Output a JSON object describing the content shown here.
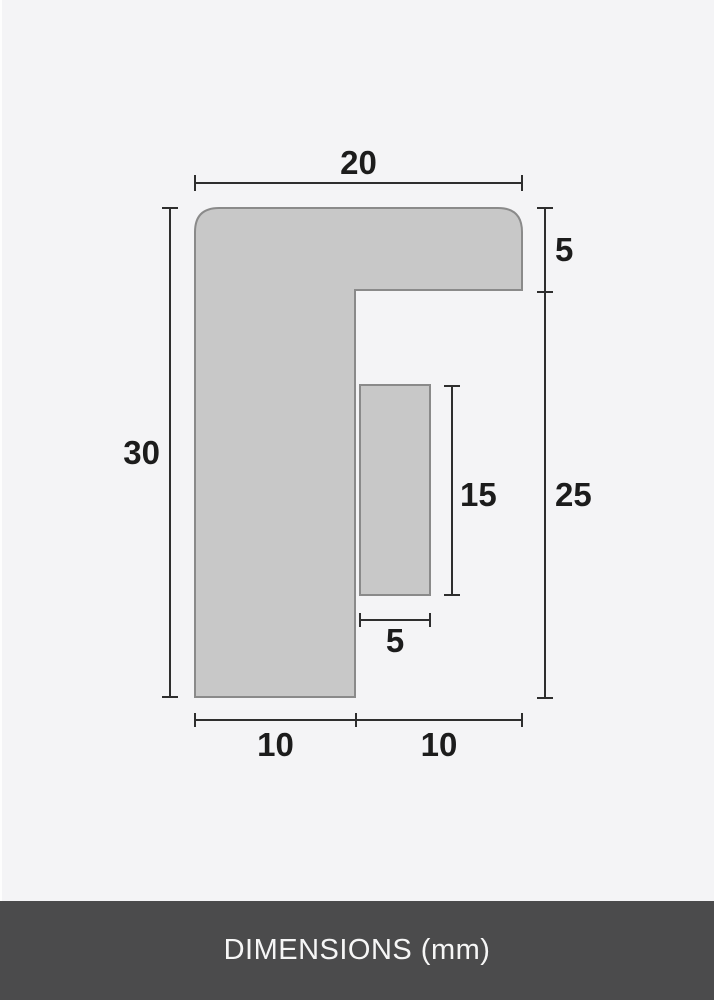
{
  "page": {
    "background_color": "#f4f4f6"
  },
  "figure": {
    "description": "frame-moulding-profile-cross-section",
    "shape_fill": "#c8c8c8",
    "shape_stroke": "#8a8a8a",
    "dimension_line_color": "#2e2e2e"
  },
  "dimensions": {
    "top_width": "20",
    "right_upper_height": "5",
    "left_height": "30",
    "inner_height": "15",
    "right_lower_height": "25",
    "inner_width": "5",
    "bottom_left_width": "10",
    "bottom_right_width": "10"
  },
  "footer": {
    "label": "DIMENSIONS (mm)",
    "background_color": "#4b4b4c",
    "text_color": "#f6f6f6"
  }
}
